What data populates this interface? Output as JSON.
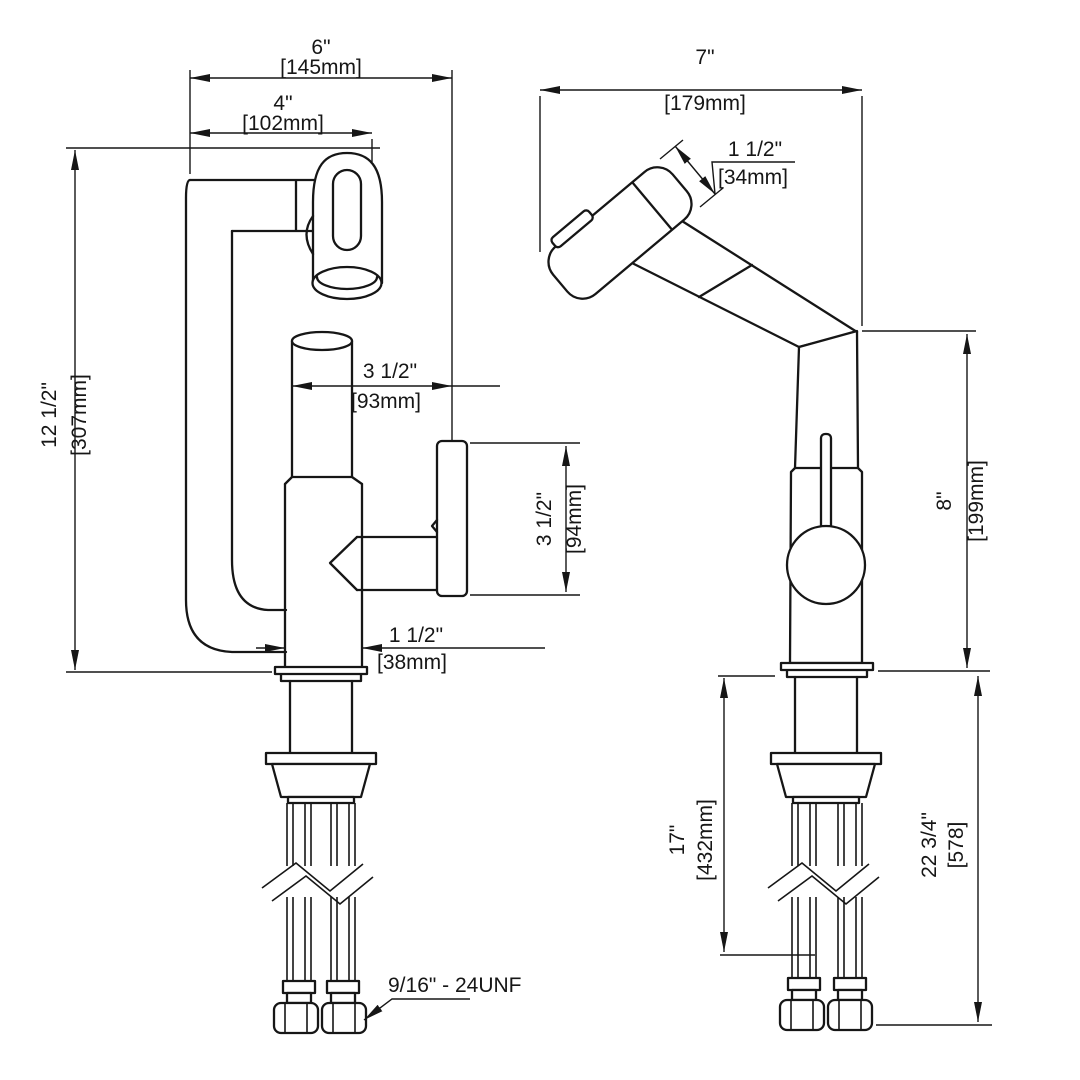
{
  "drawing": {
    "background": "#ffffff",
    "line_color": "#161616",
    "front_view": {
      "dims": {
        "overall_width": {
          "in": "6\"",
          "mm": "[145mm]"
        },
        "spout_width": {
          "in": "4\"",
          "mm": "[102mm]"
        },
        "overall_height": {
          "in": "12 1/2\"",
          "mm": "[307mm]"
        },
        "spout_to_handle": {
          "in": "3 1/2\"",
          "mm": "[93mm]"
        },
        "handle_height": {
          "in": "3 1/2\"",
          "mm": "[94mm]"
        },
        "base_width": {
          "in": "1 1/2\"",
          "mm": "[38mm]"
        },
        "thread_callout": "9/16\" - 24UNF"
      }
    },
    "side_view": {
      "dims": {
        "overall_depth": {
          "in": "7\"",
          "mm": "[179mm]"
        },
        "sprayer_width": {
          "in": "1 1/2\"",
          "mm": "[34mm]"
        },
        "spout_height": {
          "in": "8\"",
          "mm": "[199mm]"
        },
        "hose_length": {
          "in": "17\"",
          "mm": "[432mm]"
        },
        "total_below": {
          "in": "22 3/4\"",
          "mm": "[578]"
        }
      }
    }
  }
}
